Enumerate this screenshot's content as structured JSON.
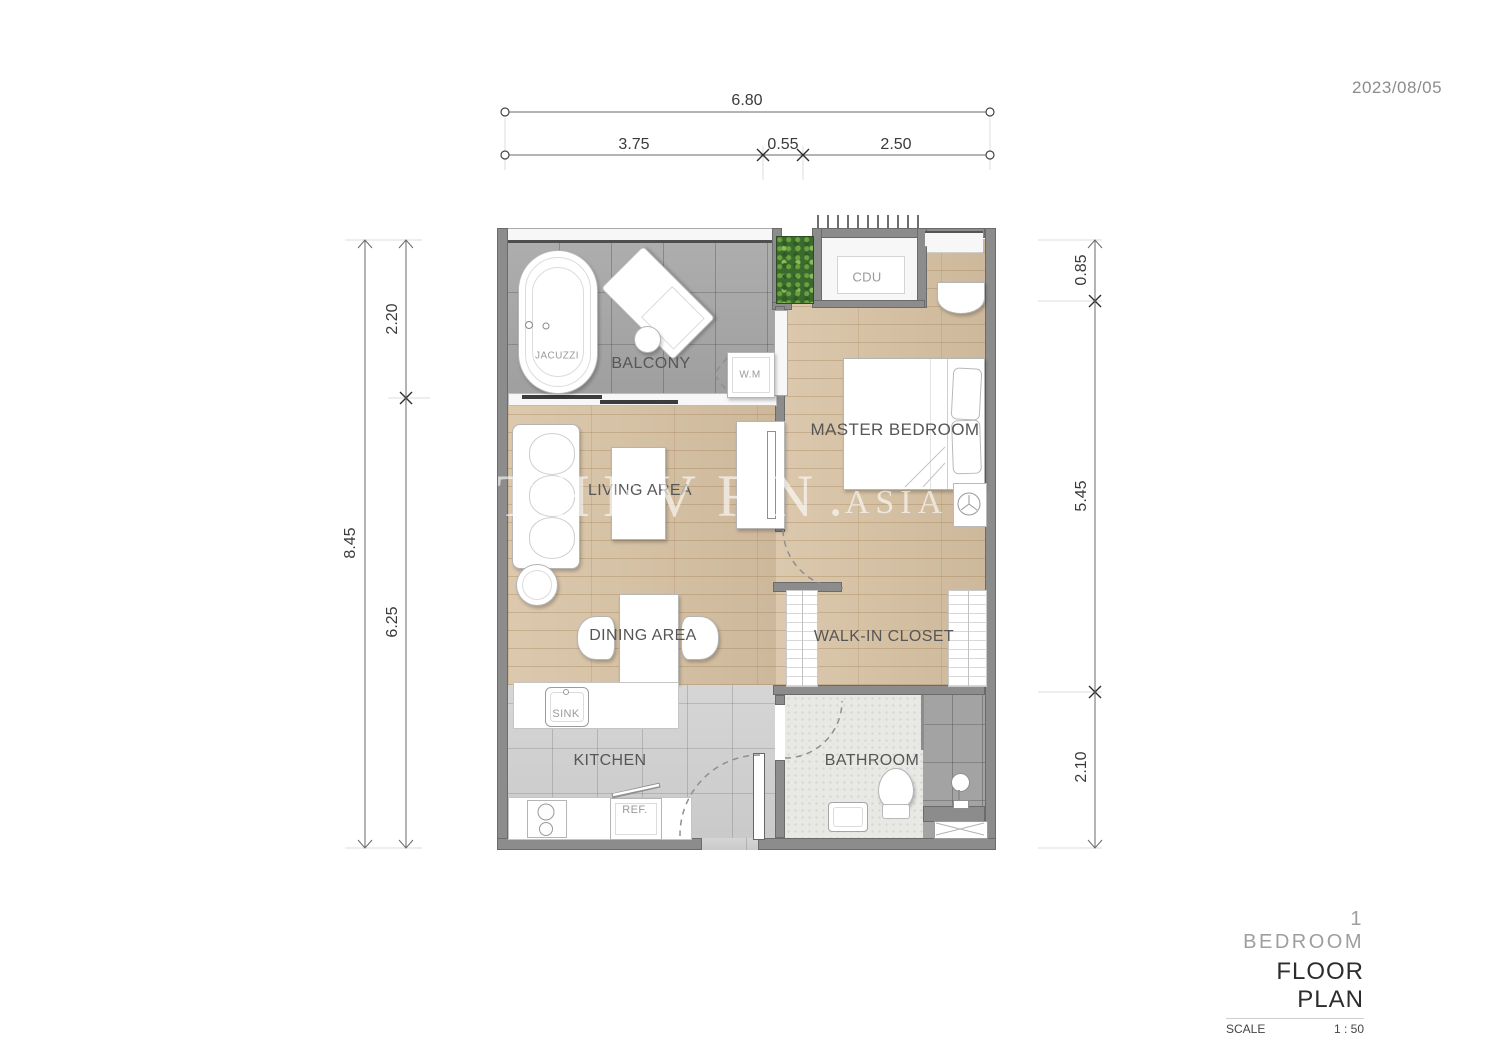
{
  "date": "2023/08/05",
  "title_block": {
    "unit": "1  BEDROOM",
    "title": "FLOOR PLAN",
    "scale_label": "SCALE",
    "scale_value": "1 : 50"
  },
  "watermark": {
    "part1": "THEV",
    "part2": "RN",
    "dot": ".",
    "suffix": "ASIA",
    "leaf_icon": "leaf-icon"
  },
  "dimensions": {
    "top_total": "6.80",
    "top_segments": [
      "3.75",
      "0.55",
      "2.50"
    ],
    "left_total": "8.45",
    "left_segments": [
      "2.20",
      "6.25"
    ],
    "right_segments": [
      "0.85",
      "5.45",
      "2.10"
    ]
  },
  "labels": {
    "balcony": "BALCONY",
    "jacuzzi": "JACUZZI",
    "wm": "W.M",
    "cdu": "CDU",
    "master_bedroom": "MASTER BEDROOM",
    "living": "LIVING AREA",
    "dining": "DINING AREA",
    "closet": "WALK-IN CLOSET",
    "kitchen": "KITCHEN",
    "bathroom": "BATHROOM",
    "sink": "SINK",
    "ref": "REF."
  },
  "colors": {
    "wall": "#8c8c8c",
    "wood": "#d8c2a3",
    "balcony_tile": "#a9a9a9",
    "kitchen_tile": "#d2d2d2",
    "bath_floor": "#e8e8e5",
    "shower_tile": "#a3a3a3",
    "planter": "#3a6b2e",
    "label": "#565656",
    "label_light": "#9a9a9a",
    "dim": "#3a3a3a"
  }
}
